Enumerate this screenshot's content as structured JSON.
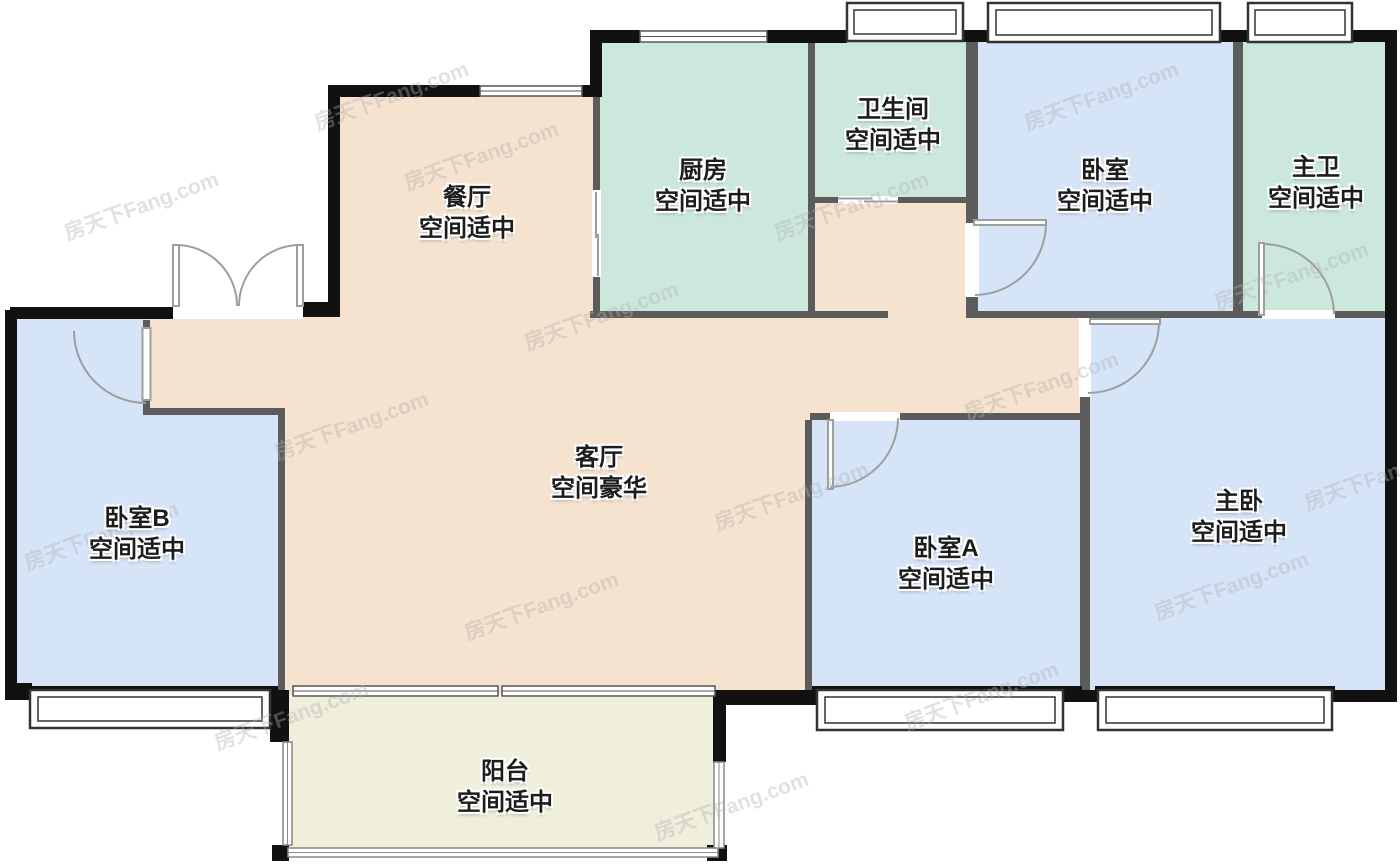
{
  "watermark": {
    "text": "房天下Fang.com"
  },
  "palette": {
    "dining_living": "#F6E3CF",
    "kitchen_bath": "#CCE8DC",
    "bedroom": "#D6E4F8",
    "balcony": "#EFEFDC",
    "wall_exterior": "#111111",
    "wall_interior": "#5C5C5C",
    "door_arc": "#9E9E9E",
    "window_line": "#555555"
  },
  "rooms": {
    "dining": {
      "name": "餐厅",
      "status": "空间适中"
    },
    "kitchen": {
      "name": "厨房",
      "status": "空间适中"
    },
    "bathroom": {
      "name": "卫生间",
      "status": "空间适中"
    },
    "bedroom": {
      "name": "卧室",
      "status": "空间适中"
    },
    "master_bath": {
      "name": "主卫",
      "status": "空间适中"
    },
    "living": {
      "name": "客厅",
      "status": "空间豪华"
    },
    "bedroom_b": {
      "name": "卧室B",
      "status": "空间适中"
    },
    "bedroom_a": {
      "name": "卧室A",
      "status": "空间适中"
    },
    "master_bedroom": {
      "name": "主卧",
      "status": "空间适中"
    },
    "balcony": {
      "name": "阳台",
      "status": "空间适中"
    }
  }
}
